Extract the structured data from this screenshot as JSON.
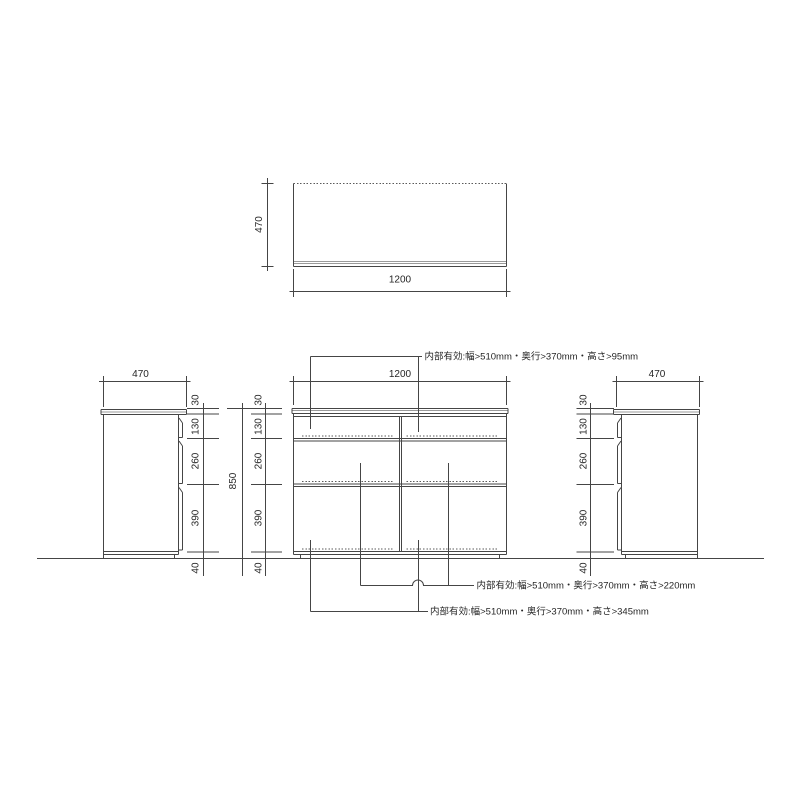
{
  "drawing": {
    "type": "furniture-dimension-drawing",
    "colors": {
      "background": "#ffffff",
      "line": "#454545",
      "light_line": "#9a9a9a",
      "text": "#262626"
    },
    "top_view": {
      "depth": "470",
      "width": "1200"
    },
    "front_view": {
      "width": "1200",
      "total_height": "850",
      "segments": [
        "30",
        "130",
        "260",
        "390",
        "40"
      ]
    },
    "left_side_view": {
      "depth": "470",
      "segments": [
        "30",
        "130",
        "260",
        "390",
        "40"
      ]
    },
    "right_side_view": {
      "depth": "470",
      "segments": [
        "30",
        "130",
        "260",
        "390",
        "40"
      ]
    },
    "annotations": {
      "top_compartment": "内部有効:幅>510mm・奥行>370mm・高さ>95mm",
      "middle_compartment": "内部有効:幅>510mm・奥行>370mm・高さ>220mm",
      "bottom_compartment": "内部有効:幅>510mm・奥行>370mm・高さ>345mm"
    }
  }
}
